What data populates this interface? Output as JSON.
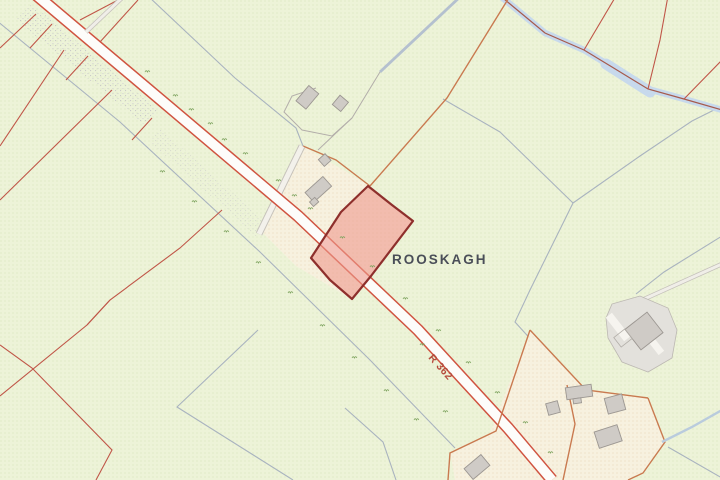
{
  "map": {
    "townland_label": "ROOSKAGH",
    "road_label": "R 362",
    "colors": {
      "field": "#edf3d8",
      "field_dot": "#d8e5bd",
      "parcel_cream": "#f7f1df",
      "cream_dot": "#e9d9ba",
      "road_fill": "#fdfcfa",
      "road_casing": "#d05340",
      "boundary_red": "#c05648",
      "boundary_orange": "#c97a50",
      "hedge_gray": "#a9b3bf",
      "water_fill": "#c7d9ec",
      "water_line": "#a65a4c",
      "building_fill": "#cfcbc6",
      "building_stroke": "#9c9792",
      "highlight_fill": "#ee9a8d",
      "highlight_stroke": "#8e2f2c",
      "label_dark": "#4a4e58",
      "road_label_color": "#b54a3c",
      "scrub_green": "#7da35e"
    }
  }
}
